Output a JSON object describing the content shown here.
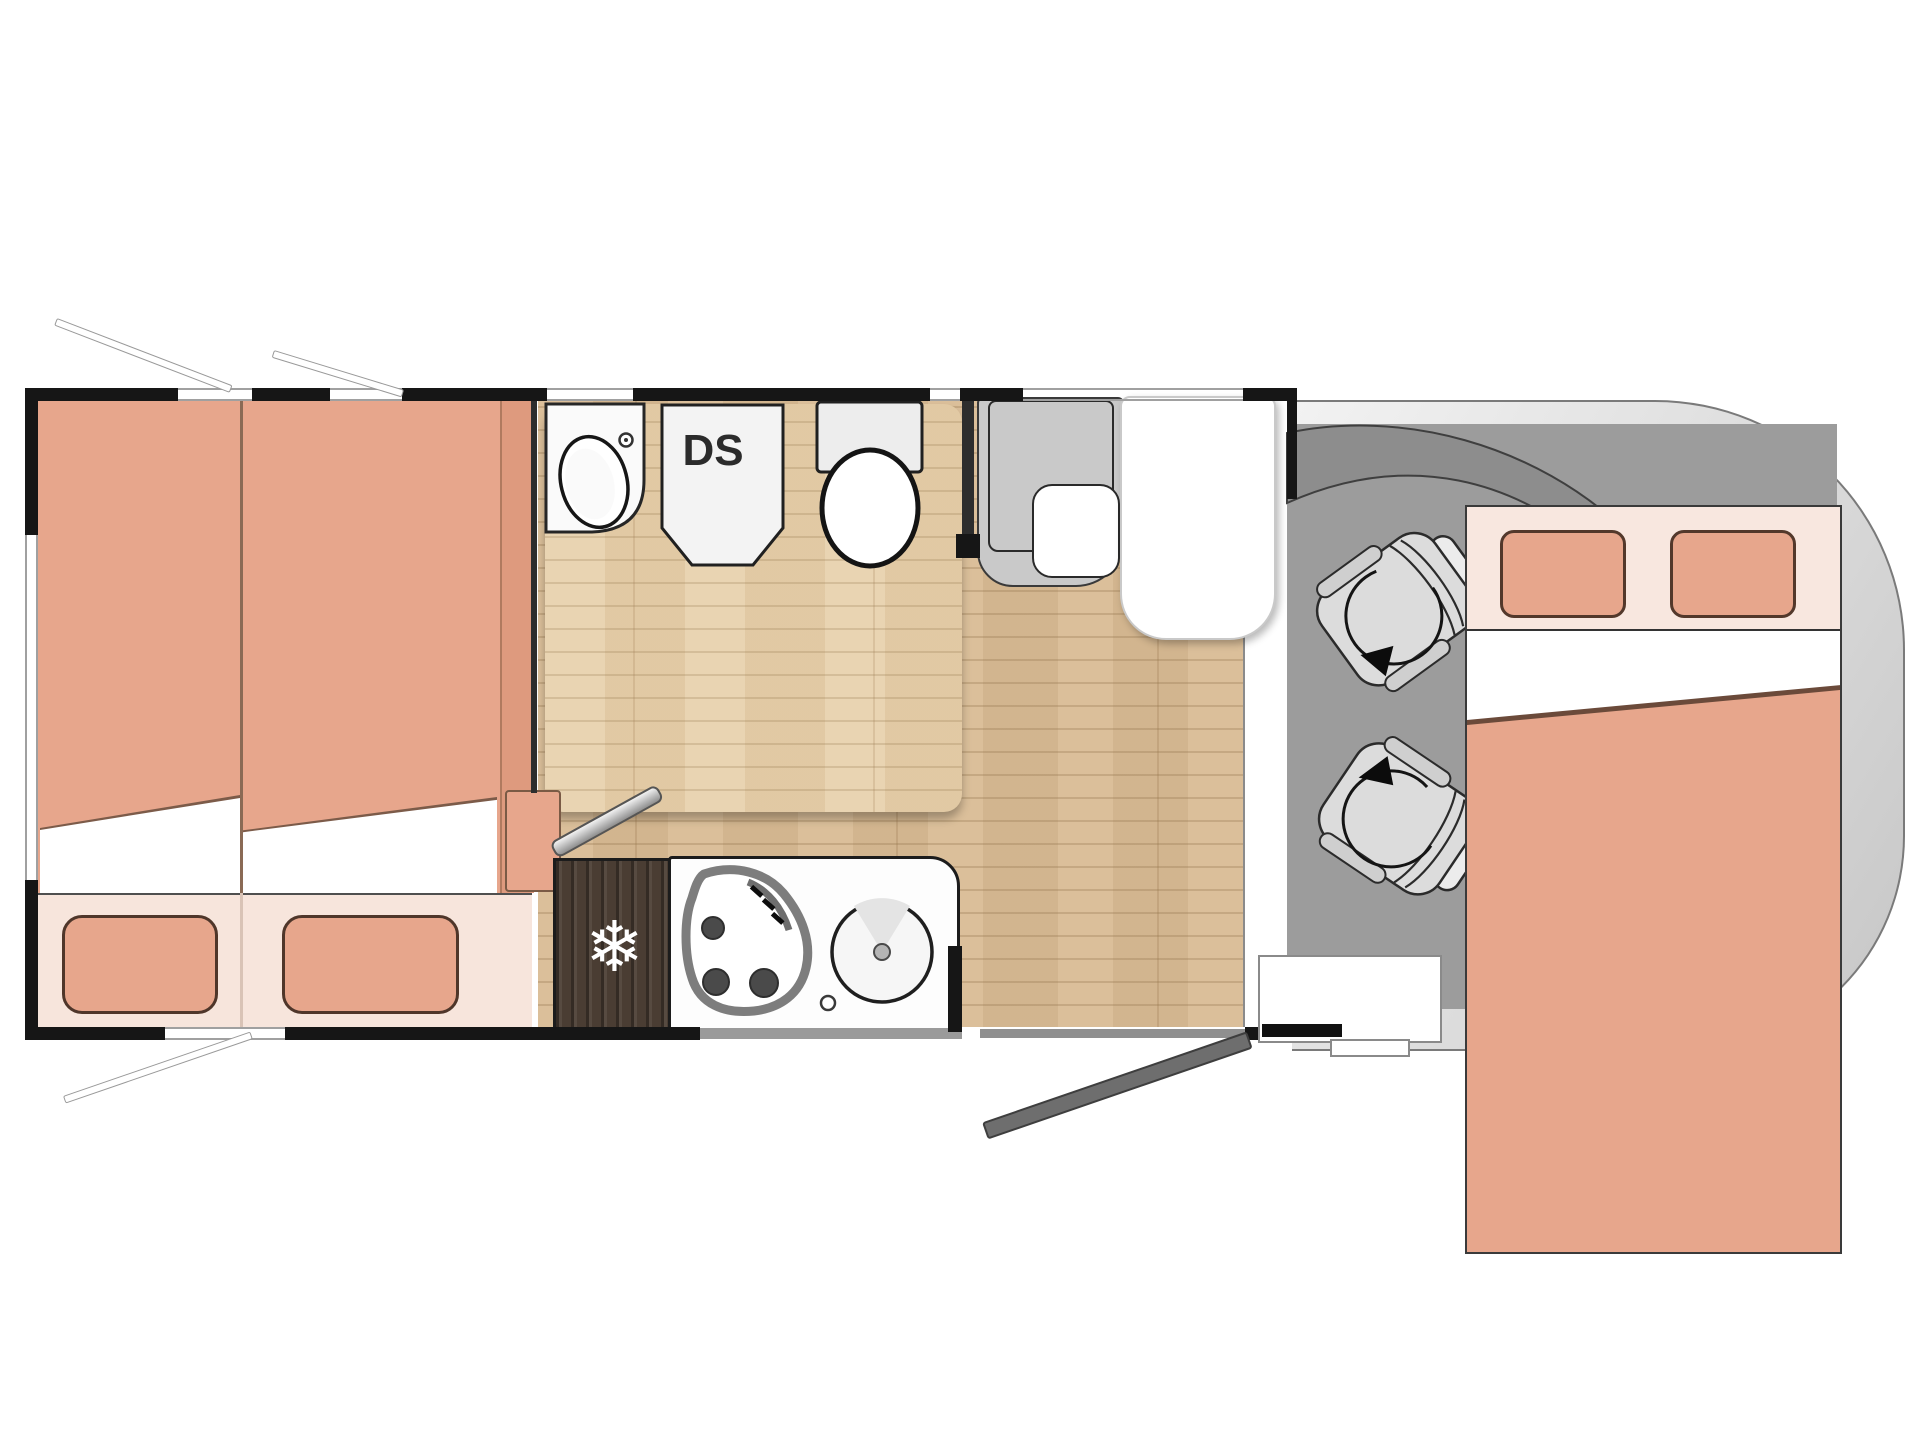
{
  "title": "Motorhome floor plan diagram",
  "labels": {
    "shower_unit": "DS"
  },
  "icons": {
    "snowflake": {
      "name": "snowflake-icon",
      "glyph": "❄"
    },
    "rotation_arrows": [
      "rotation-arrow-icon",
      "rotation-arrow-icon"
    ]
  },
  "palette": {
    "wall": "#161616",
    "mattress_salmon": "#e7a68c",
    "bed_base_light": "#f7e5dc",
    "wood_floor": "#d9bc95",
    "bathroom_floor": "#e7cfa9",
    "cab_floor": "#9c9c9c",
    "windshield": "#8d8d8d",
    "vehicle_body_light": "#f2f2f2",
    "vehicle_body_dark": "#c6c6c6",
    "fridge_wood": "#4a3d33",
    "fixture_white": "#ffffff",
    "outline": "#2b2b2b"
  },
  "rooms": {
    "rear_bedroom": {
      "name": "twin single beds",
      "beds": 2,
      "pillows": 2,
      "windows_open": 3
    },
    "bathroom": {
      "name": "bathroom",
      "fixtures": [
        "washbasin",
        "shower cabin",
        "toilet"
      ]
    },
    "kitchen": {
      "name": "kitchen",
      "fixtures": [
        "refrigerator",
        "3-burner hob",
        "round sink",
        "faucet"
      ]
    },
    "lounge": {
      "name": "lounge",
      "furniture": [
        "bench sofa",
        "table"
      ]
    },
    "cab": {
      "name": "driver cab",
      "furniture": [
        "swivel seat",
        "swivel seat"
      ]
    },
    "front_bed": {
      "name": "drop-down double bed",
      "pillows": 2
    },
    "entry": {
      "name": "entrance",
      "furniture": [
        "inner step",
        "outer step",
        "open door"
      ]
    }
  }
}
